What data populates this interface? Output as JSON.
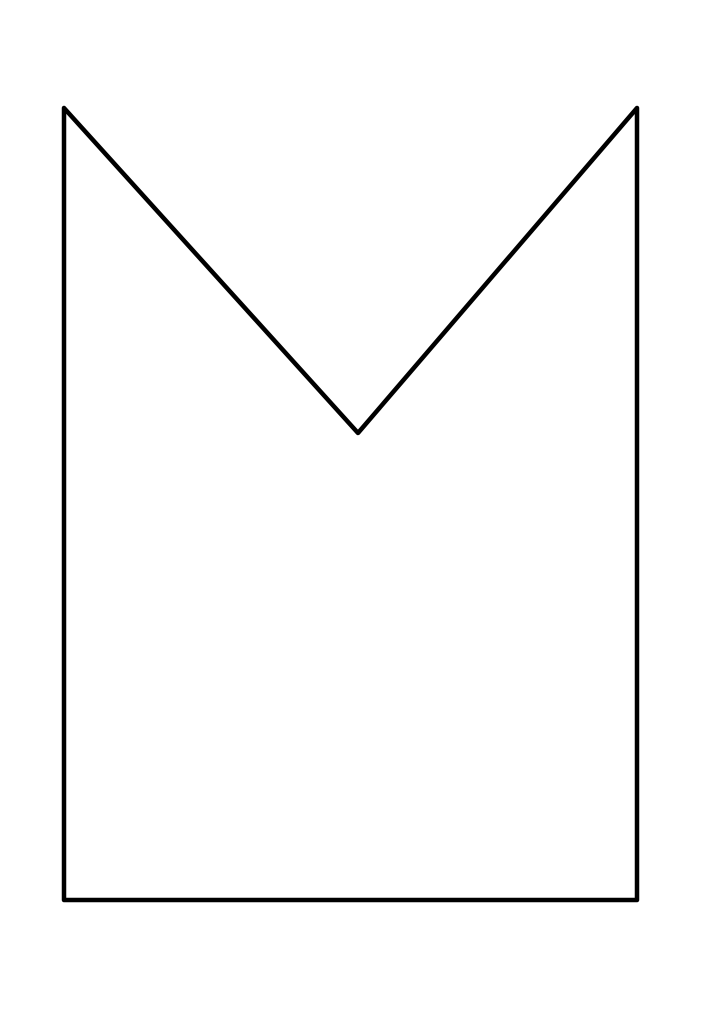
{
  "canvas": {
    "width": 706,
    "height": 1024,
    "background_color": "#ffffff"
  },
  "drawing": {
    "description": "envelope-back outline: rectangle with deep V notch cut into top edge",
    "shape": {
      "type": "polygon",
      "points": "64,108 358,433 637,108 637,900 64,900",
      "fill": "none",
      "stroke_color": "#000000",
      "stroke_width": "4.5",
      "linejoin": "round",
      "linecap": "round"
    },
    "vertices": [
      {
        "label": "top-left-peak",
        "x": 64,
        "y": 108
      },
      {
        "label": "v-notch-bottom",
        "x": 358,
        "y": 433
      },
      {
        "label": "top-right-peak",
        "x": 637,
        "y": 108
      },
      {
        "label": "bottom-right",
        "x": 637,
        "y": 900
      },
      {
        "label": "bottom-left",
        "x": 64,
        "y": 900
      }
    ]
  }
}
